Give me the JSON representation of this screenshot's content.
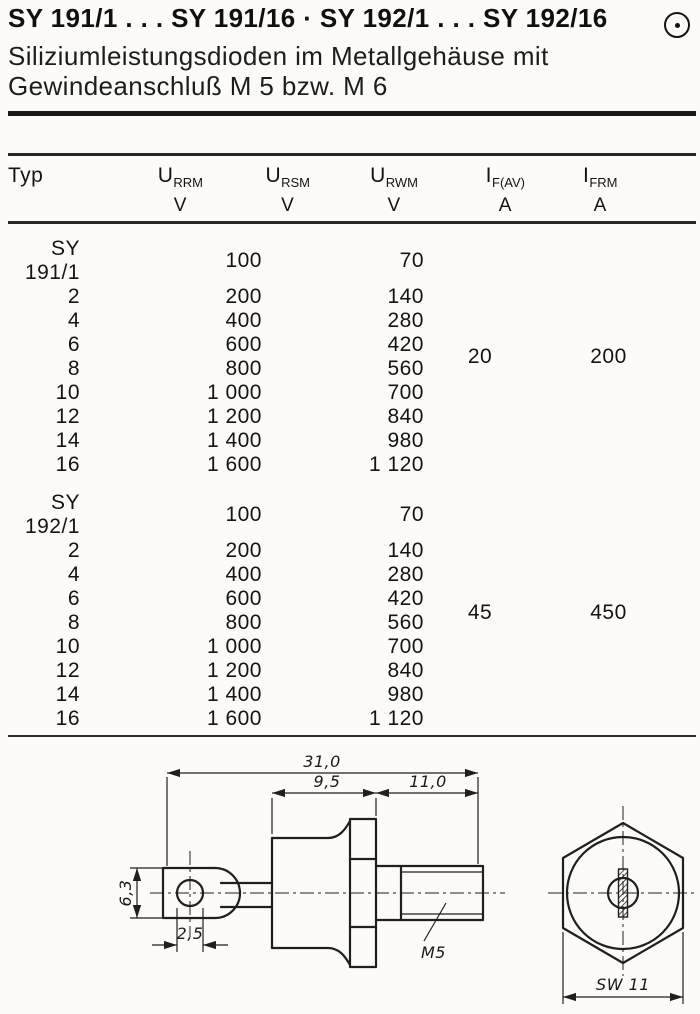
{
  "header": {
    "title": "SY 191/1 . . . SY 191/16 · SY 192/1 . . . SY 192/16",
    "subtitle_line1": "Siliziumleistungsdioden im Metallgehäuse mit",
    "subtitle_line2": "Gewindeanschluß M 5 bzw. M 6",
    "logo_icon": "circled-dot"
  },
  "table": {
    "columns": [
      {
        "label": "Typ",
        "sub": "",
        "unit": ""
      },
      {
        "label": "U",
        "sub": "RRM",
        "unit": "V"
      },
      {
        "label": "U",
        "sub": "RSM",
        "unit": "V"
      },
      {
        "label": "U",
        "sub": "RWM",
        "unit": "V"
      },
      {
        "label": "I",
        "sub": "F(AV)",
        "unit": "A"
      },
      {
        "label": "I",
        "sub": "FRM",
        "unit": "A"
      }
    ],
    "groups": [
      {
        "if_av": "20",
        "ifrm": "200",
        "rows": [
          {
            "typ": "SY 191/1",
            "urrm": "100",
            "ursm": "",
            "urwm": "70"
          },
          {
            "typ": "2",
            "urrm": "200",
            "ursm": "",
            "urwm": "140"
          },
          {
            "typ": "4",
            "urrm": "400",
            "ursm": "",
            "urwm": "280"
          },
          {
            "typ": "6",
            "urrm": "600",
            "ursm": "",
            "urwm": "420"
          },
          {
            "typ": "8",
            "urrm": "800",
            "ursm": "",
            "urwm": "560"
          },
          {
            "typ": "10",
            "urrm": "1 000",
            "ursm": "",
            "urwm": "700"
          },
          {
            "typ": "12",
            "urrm": "1 200",
            "ursm": "",
            "urwm": "840"
          },
          {
            "typ": "14",
            "urrm": "1 400",
            "ursm": "",
            "urwm": "980"
          },
          {
            "typ": "16",
            "urrm": "1 600",
            "ursm": "",
            "urwm": "1 120"
          }
        ]
      },
      {
        "if_av": "45",
        "ifrm": "450",
        "rows": [
          {
            "typ": "SY 192/1",
            "urrm": "100",
            "ursm": "",
            "urwm": "70"
          },
          {
            "typ": "2",
            "urrm": "200",
            "ursm": "",
            "urwm": "140"
          },
          {
            "typ": "4",
            "urrm": "400",
            "ursm": "",
            "urwm": "280"
          },
          {
            "typ": "6",
            "urrm": "600",
            "ursm": "",
            "urwm": "420"
          },
          {
            "typ": "8",
            "urrm": "800",
            "ursm": "",
            "urwm": "560"
          },
          {
            "typ": "10",
            "urrm": "1 000",
            "ursm": "",
            "urwm": "700"
          },
          {
            "typ": "12",
            "urrm": "1 200",
            "ursm": "",
            "urwm": "840"
          },
          {
            "typ": "14",
            "urrm": "1 400",
            "ursm": "",
            "urwm": "980"
          },
          {
            "typ": "16",
            "urrm": "1 600",
            "ursm": "",
            "urwm": "1 120"
          }
        ]
      }
    ]
  },
  "drawing": {
    "dim_overall": "31,0",
    "dim_body": "9,5",
    "dim_thread": "11,0",
    "dim_tab_height": "6,3",
    "dim_hole": "2,5",
    "thread_label": "M5",
    "wrench_size": "SW 11"
  }
}
